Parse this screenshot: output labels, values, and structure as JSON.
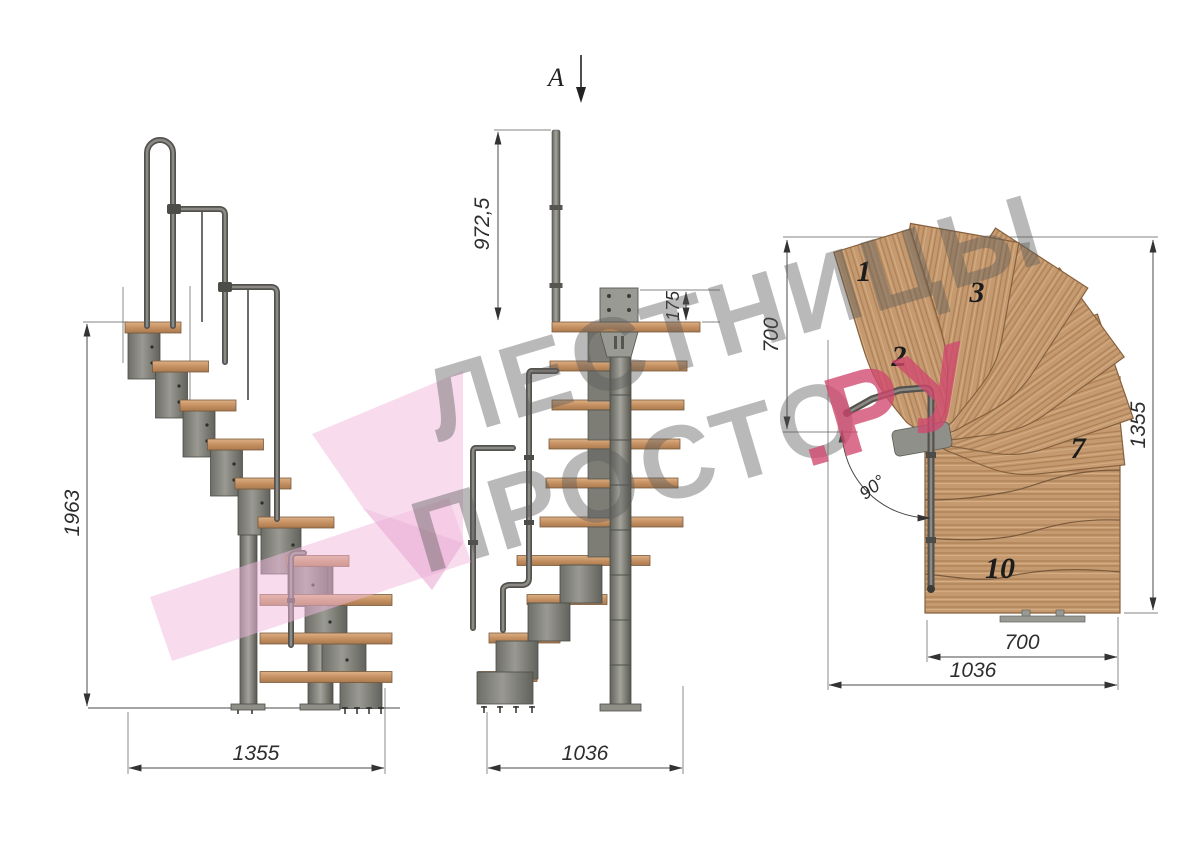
{
  "drawing": {
    "section_label": "A",
    "watermark": {
      "line1": "ЛЕСТНИЦЫ",
      "line2": "ПРОСТО",
      "line2_suffix": ".РУ"
    },
    "side_view": {
      "height_dim": "1963",
      "width_dim": "1355"
    },
    "front_view": {
      "rail_height_dim": "972,5",
      "plate_dim": "175",
      "width_dim": "1036"
    },
    "plan_view": {
      "left_dim": "700",
      "right_dim": "1355",
      "bottom_inner_dim": "700",
      "bottom_outer_dim": "1036",
      "angle_dim": "90°",
      "step_labels": [
        "1",
        "2",
        "3",
        "7",
        "10"
      ]
    },
    "colors": {
      "wood": "#c59a70",
      "wood_streak": "#b08255",
      "metal": "#84847e",
      "dim_line": "#4a4a4a",
      "watermark_gray": "#5a5a5a",
      "watermark_pink_text": "#d1496f",
      "watermark_pink_logo": "#f2bade"
    }
  }
}
